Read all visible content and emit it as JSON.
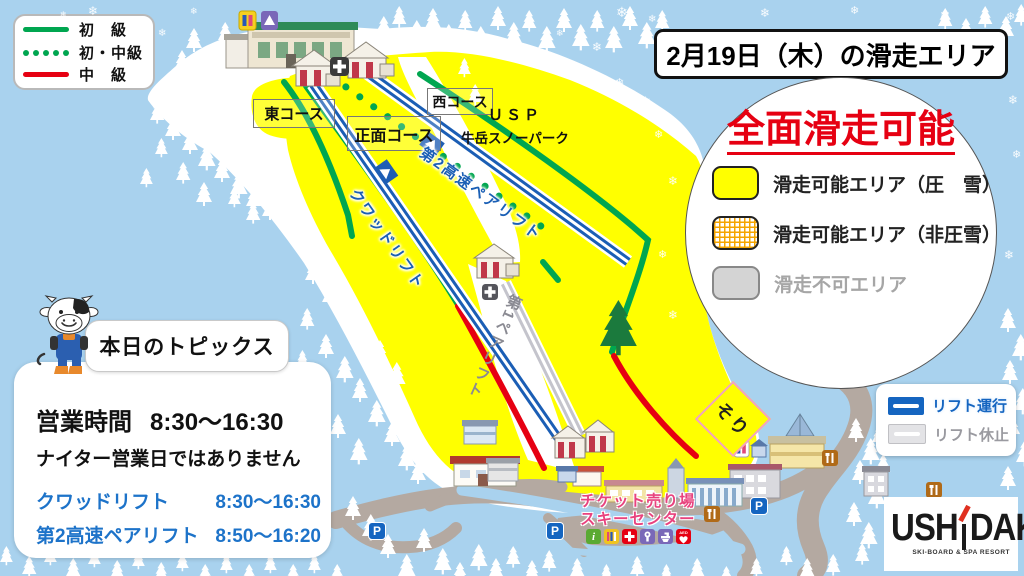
{
  "course_legend": {
    "items": [
      {
        "label": "初　級",
        "style": "solid",
        "color": "#00a650"
      },
      {
        "label": "初・中級",
        "style": "dotted",
        "color": "#00a650"
      },
      {
        "label": "中　級",
        "style": "solid",
        "color": "#e60012"
      }
    ]
  },
  "header": {
    "title": "2月19日（木）の滑走エリア"
  },
  "status_panel": {
    "headline": "全面滑走可能",
    "items": [
      {
        "label": "滑走可能エリア（圧　雪）",
        "swatch": "groomed"
      },
      {
        "label": "滑走可能エリア（非圧雪）",
        "swatch": "ungroomed"
      },
      {
        "label": "滑走不可エリア",
        "swatch": "closed"
      }
    ]
  },
  "lift_legend": {
    "running": "リフト運行",
    "stopped": "リフト休止"
  },
  "map": {
    "courses": [
      {
        "name": "東コース"
      },
      {
        "name": "正面コース"
      },
      {
        "name": "西コース"
      }
    ],
    "snow_park": {
      "line1": "ＵＳＰ",
      "line2": "牛岳スノーパーク"
    },
    "lifts": [
      {
        "name": "第2高速ペアリフト"
      },
      {
        "name": "クワッドリフト"
      },
      {
        "name": "第1ペアリフト"
      }
    ],
    "sled_area": "そり",
    "ticket": {
      "line1": "チケット売り場",
      "line2": "スキーセンター"
    },
    "parking": "P",
    "facilities": [
      "info",
      "rental",
      "first-aid",
      "coin-locker",
      "washroom",
      "aed"
    ],
    "aed_label": "AED"
  },
  "topics": {
    "title": "本日のトピックス",
    "hours_label": "営業時間",
    "hours_value": "8:30～16:30",
    "note": "ナイター営業日ではありません",
    "lifts": [
      {
        "name": "クワッドリフト",
        "time": "8:30～16:30"
      },
      {
        "name": "第2高速ペアリフト",
        "time": "8:50～16:20"
      }
    ]
  },
  "logo": {
    "part1": "USH",
    "part2": "DAKE",
    "subtitle": "SKI-BOARD & SPA RESORT"
  },
  "colors": {
    "sky": "#a9d2ee",
    "slope_open": "#ffff00",
    "beginner": "#00a650",
    "intermediate": "#e60012",
    "lift_running": "#1b5eb5",
    "lift_stopped": "#c4c4cc",
    "headline_red": "#e60012",
    "ticket_pink": "#e8427e",
    "topics_blue": "#1d73c9"
  }
}
